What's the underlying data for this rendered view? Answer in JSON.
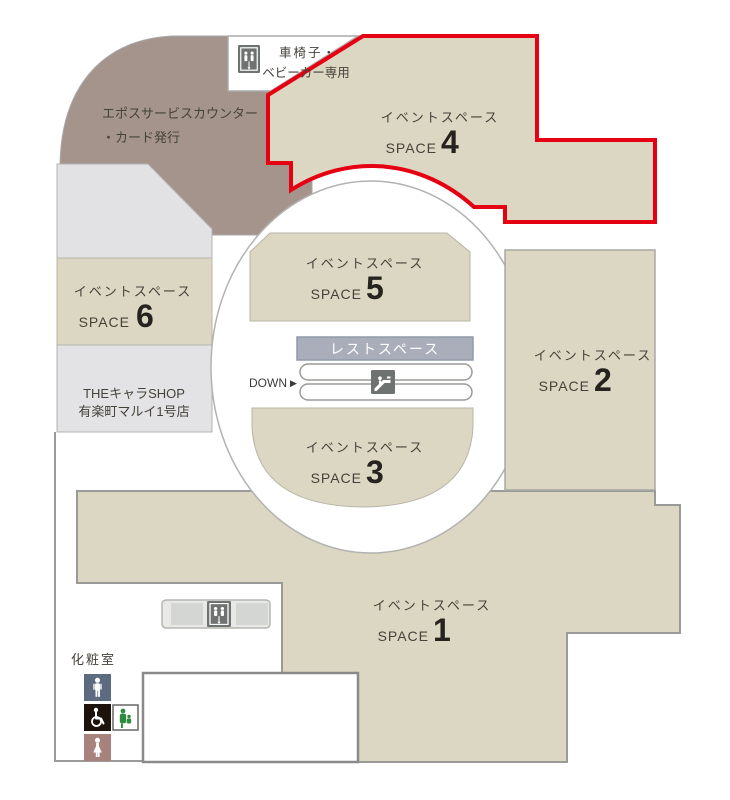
{
  "spaces": [
    {
      "label": "イベントスペース",
      "space": "SPACE",
      "number": "1"
    },
    {
      "label": "イベントスペース",
      "space": "SPACE",
      "number": "2"
    },
    {
      "label": "イベントスペース",
      "space": "SPACE",
      "number": "3"
    },
    {
      "label": "イベントスペース",
      "space": "SPACE",
      "number": "4"
    },
    {
      "label": "イベントスペース",
      "space": "SPACE",
      "number": "5"
    },
    {
      "label": "イベントスペース",
      "space": "SPACE",
      "number": "6"
    }
  ],
  "facilities": {
    "wheelchair_stroller_line1": "車椅子・",
    "wheelchair_stroller_line2": "ベビーカー専用",
    "epos_line1": "エポスサービスカウンター",
    "epos_line2": "・カード発行",
    "shop_line1": "THEキャラSHOP",
    "shop_line2": "有楽町マルイ1号店",
    "rest_space": "レストスペース",
    "down": "DOWN",
    "down_arrow": "▶",
    "restroom": "化粧室"
  },
  "highlight": {
    "space_number": "4",
    "color": "#e50012"
  },
  "icons": {
    "elevator": "elevator-icon",
    "escalator": "escalator-icon",
    "restroom_male": "male-restroom-icon",
    "restroom_accessible": "wheelchair-accessible-icon",
    "baby_care": "baby-care-icon",
    "restroom_female": "female-restroom-icon"
  },
  "colors": {
    "highlight_red": "#e50012",
    "space_beige": "#dcd7c3",
    "service_brown": "#a5948c",
    "rest_space_gray": "#a9aeba",
    "male_icon_bg": "#5d6b80",
    "accessible_icon_bg": "#1d120c",
    "female_icon_bg": "#a8837d",
    "baby_icon_green": "#2e8b3e"
  }
}
